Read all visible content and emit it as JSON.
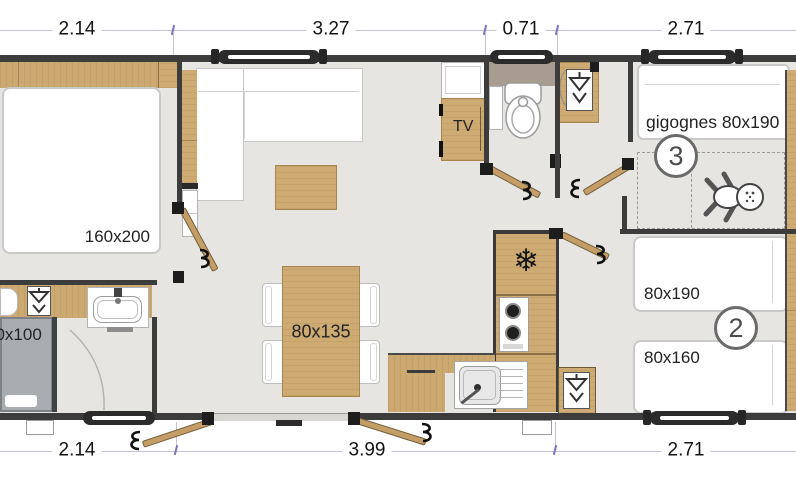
{
  "plan": {
    "dimensions_top": [
      "2.14",
      "3.27",
      "0.71",
      "2.71"
    ],
    "dimensions_bottom": [
      "2.14",
      "3.99",
      "2.71"
    ],
    "master_bedroom": {
      "bed_label": "160x200"
    },
    "living_room": {
      "tv_label": "TV",
      "table_label": "80x135"
    },
    "bathroom": {
      "shower_label": "80x100"
    },
    "bedroom3": {
      "number": "3",
      "bed_label": "gigognes 80x190"
    },
    "bedroom2": {
      "number": "2",
      "bed_top_label": "80x190",
      "bed_bottom_label": "80x160"
    },
    "colors": {
      "wall": "#3c3c3c",
      "wood": "#cda972",
      "floor": "#e6e5e2",
      "shower_tray": "#a9adb1",
      "dimension_tick": "#7d72bd",
      "wc_shelf": "#a89c90"
    }
  }
}
